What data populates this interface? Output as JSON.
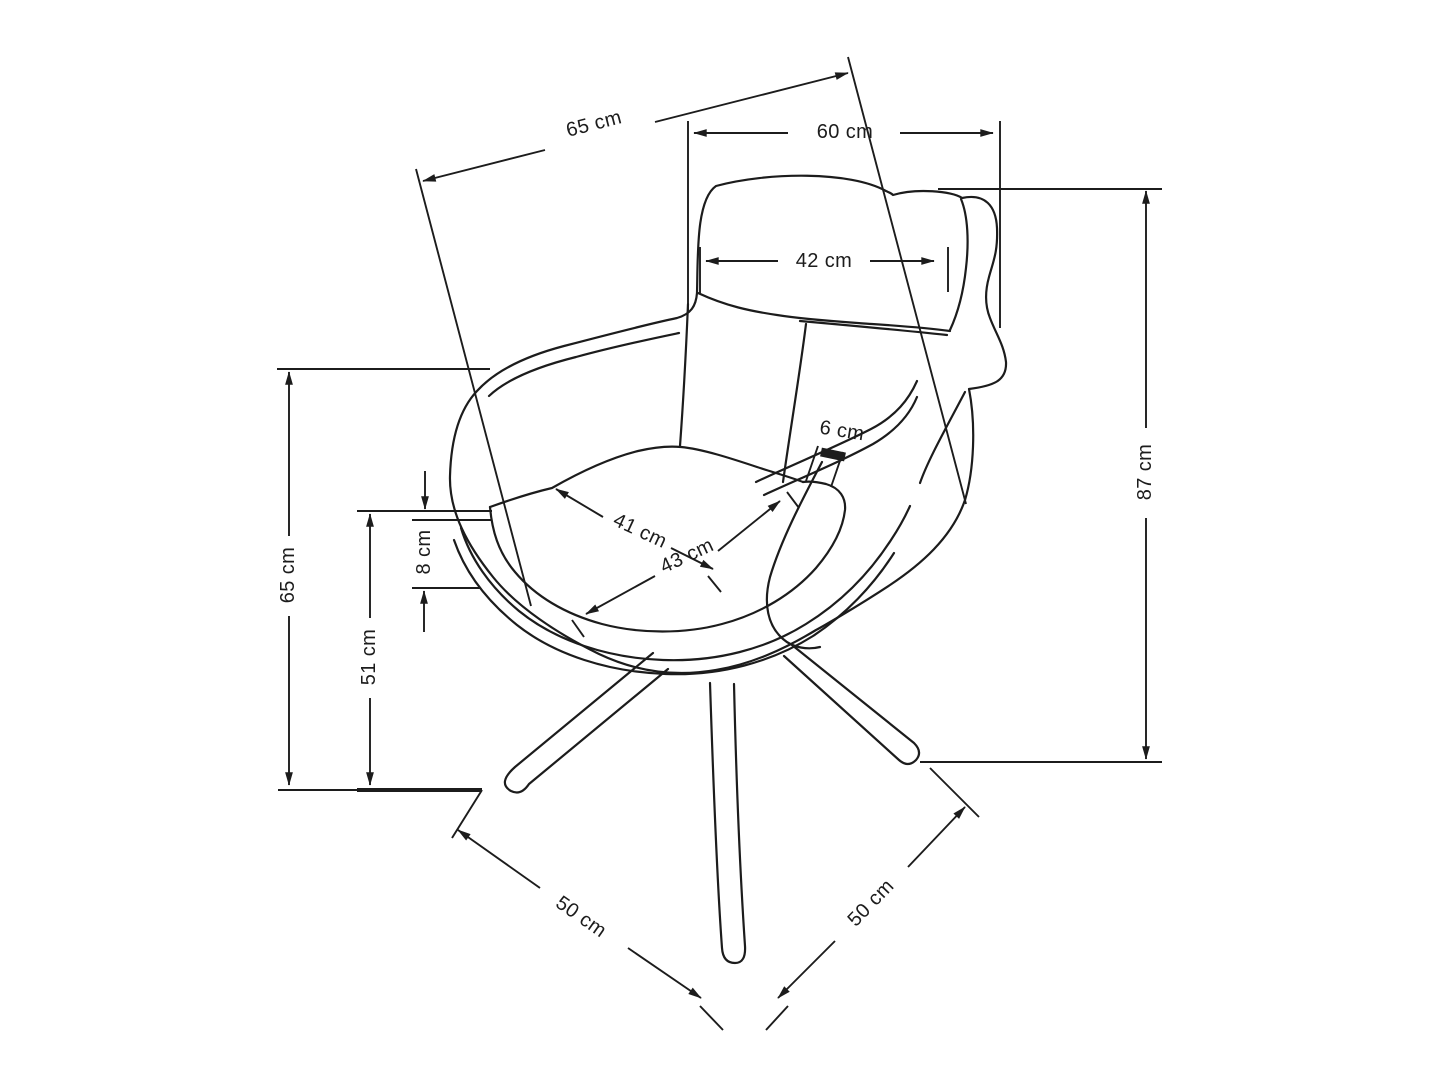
{
  "figure": {
    "type": "furniture-dimension-diagram",
    "subject": "armchair line drawing with measurements",
    "background_color": "#ffffff",
    "line_color": "#1c1c1c",
    "unit": "cm"
  },
  "labels": {
    "depth_diagonal": "65 cm",
    "width_overall": "60 cm",
    "headrest_width": "42 cm",
    "armrest_thickness": "6 cm",
    "seat_width": "41 cm",
    "seat_depth": "43 cm",
    "cushion_thickness": "8 cm",
    "armrest_height": "65 cm",
    "seat_height": "51 cm",
    "height_overall": "87 cm",
    "base_left": "50 cm",
    "base_right": "50 cm"
  }
}
